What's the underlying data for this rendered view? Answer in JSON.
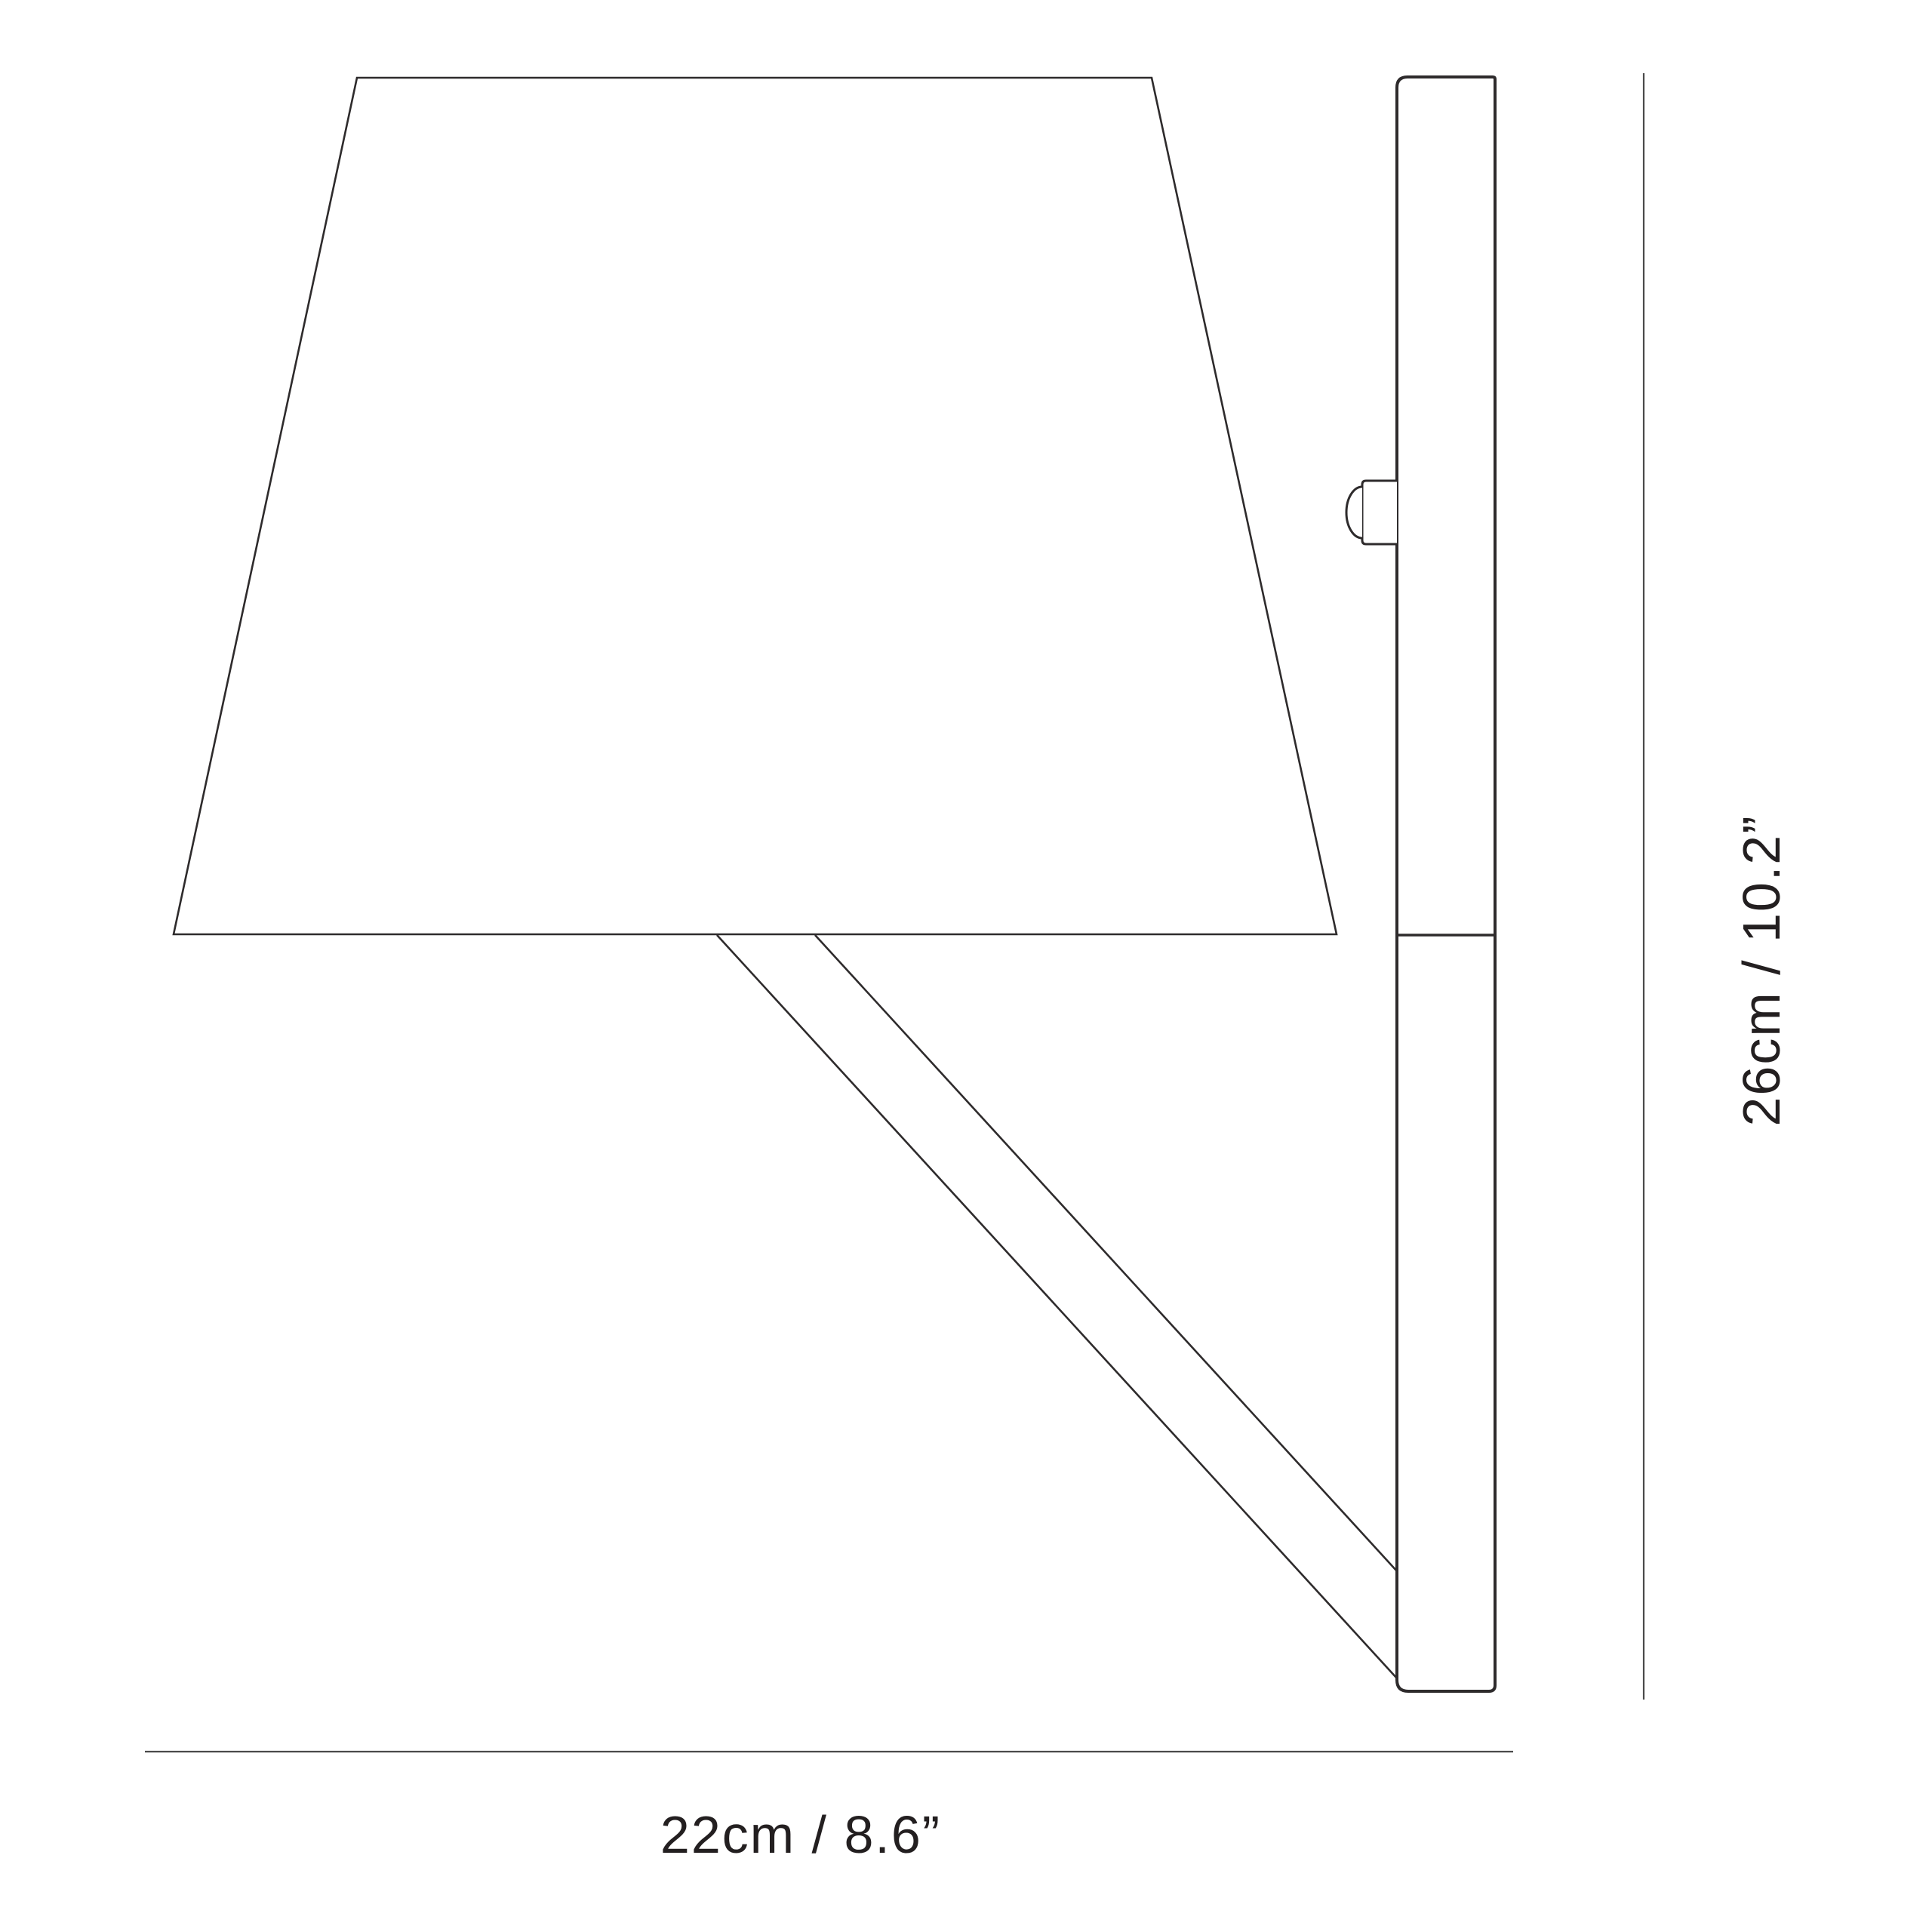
{
  "diagram": {
    "type": "product-dimension-drawing",
    "subject": "wall lamp side elevation",
    "width_dimension": {
      "label": "22cm / 8.6”",
      "value_cm": 22,
      "value_in": 8.6,
      "orientation": "horizontal"
    },
    "height_dimension": {
      "label": "26cm / 10.2”",
      "value_cm": 26,
      "value_in": 10.2,
      "orientation": "vertical"
    },
    "colors": {
      "background": "#ffffff",
      "line": "#2e2b2c",
      "dimension_line": "#4a4a4a",
      "text": "#231f20"
    }
  }
}
